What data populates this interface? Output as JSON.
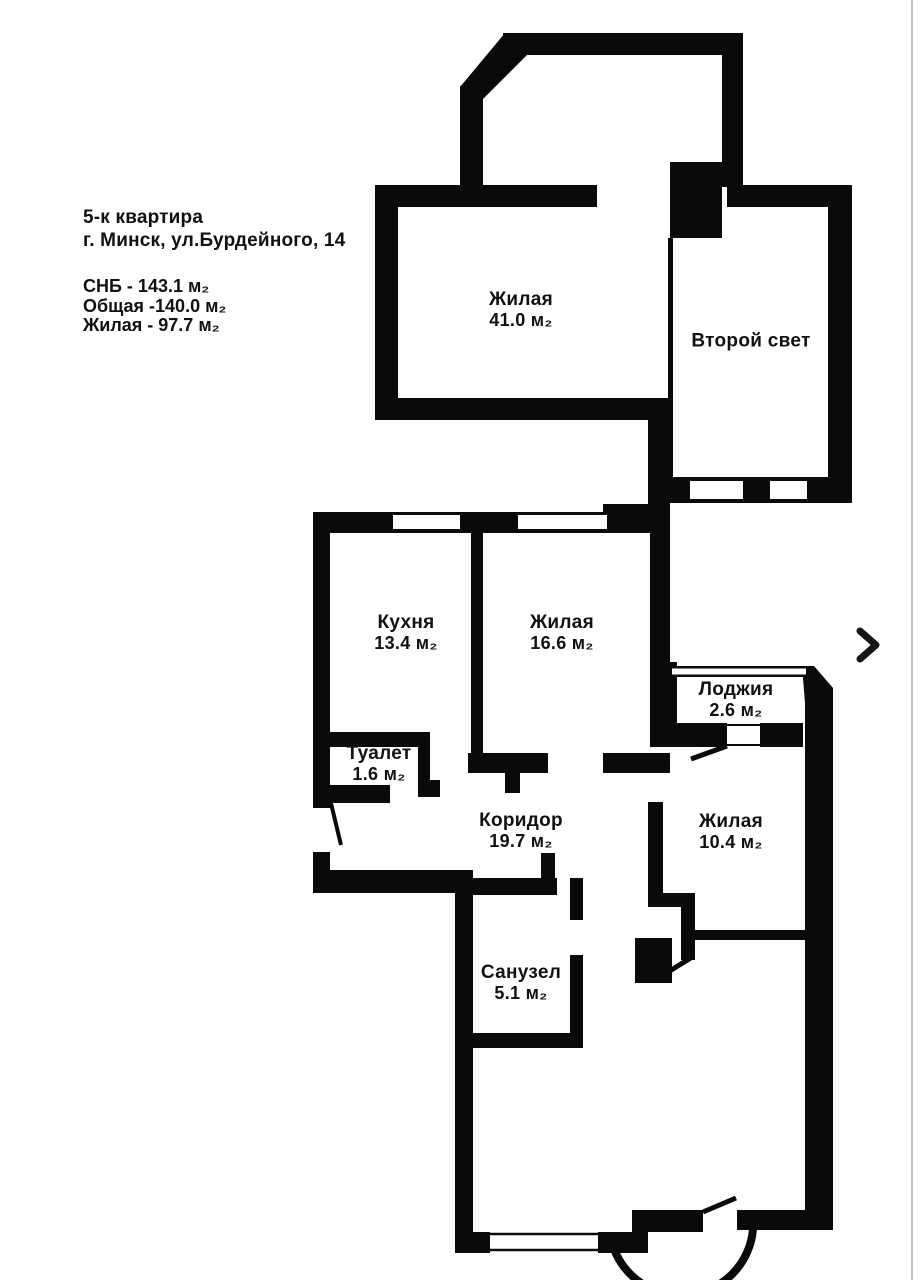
{
  "colors": {
    "wall": "#0a0a0a",
    "background": "#ffffff",
    "text": "#111111"
  },
  "header": {
    "line1": "5-к квартира",
    "line2": "г. Минск, ул.Бурдейного, 14",
    "stats": [
      "СНБ - 143.1 м₂",
      "Общая -140.0 м₂",
      "Жилая -  97.7 м₂"
    ]
  },
  "rooms": [
    {
      "name": "Жилая",
      "area": "41.0 м₂"
    },
    {
      "name": "Второй свет",
      "area": ""
    },
    {
      "name": "Кухня",
      "area": "13.4 м₂"
    },
    {
      "name": "Жилая",
      "area": "16.6 м₂"
    },
    {
      "name": "Лоджия",
      "area": "2.6 м₂"
    },
    {
      "name": "Туалет",
      "area": "1.6 м₂"
    },
    {
      "name": "Коридор",
      "area": "19.7 м₂"
    },
    {
      "name": "Жилая",
      "area": "10.4 м₂"
    },
    {
      "name": "Санузел",
      "area": "5.1 м₂"
    }
  ],
  "icons": {
    "next": "chevron-right"
  }
}
